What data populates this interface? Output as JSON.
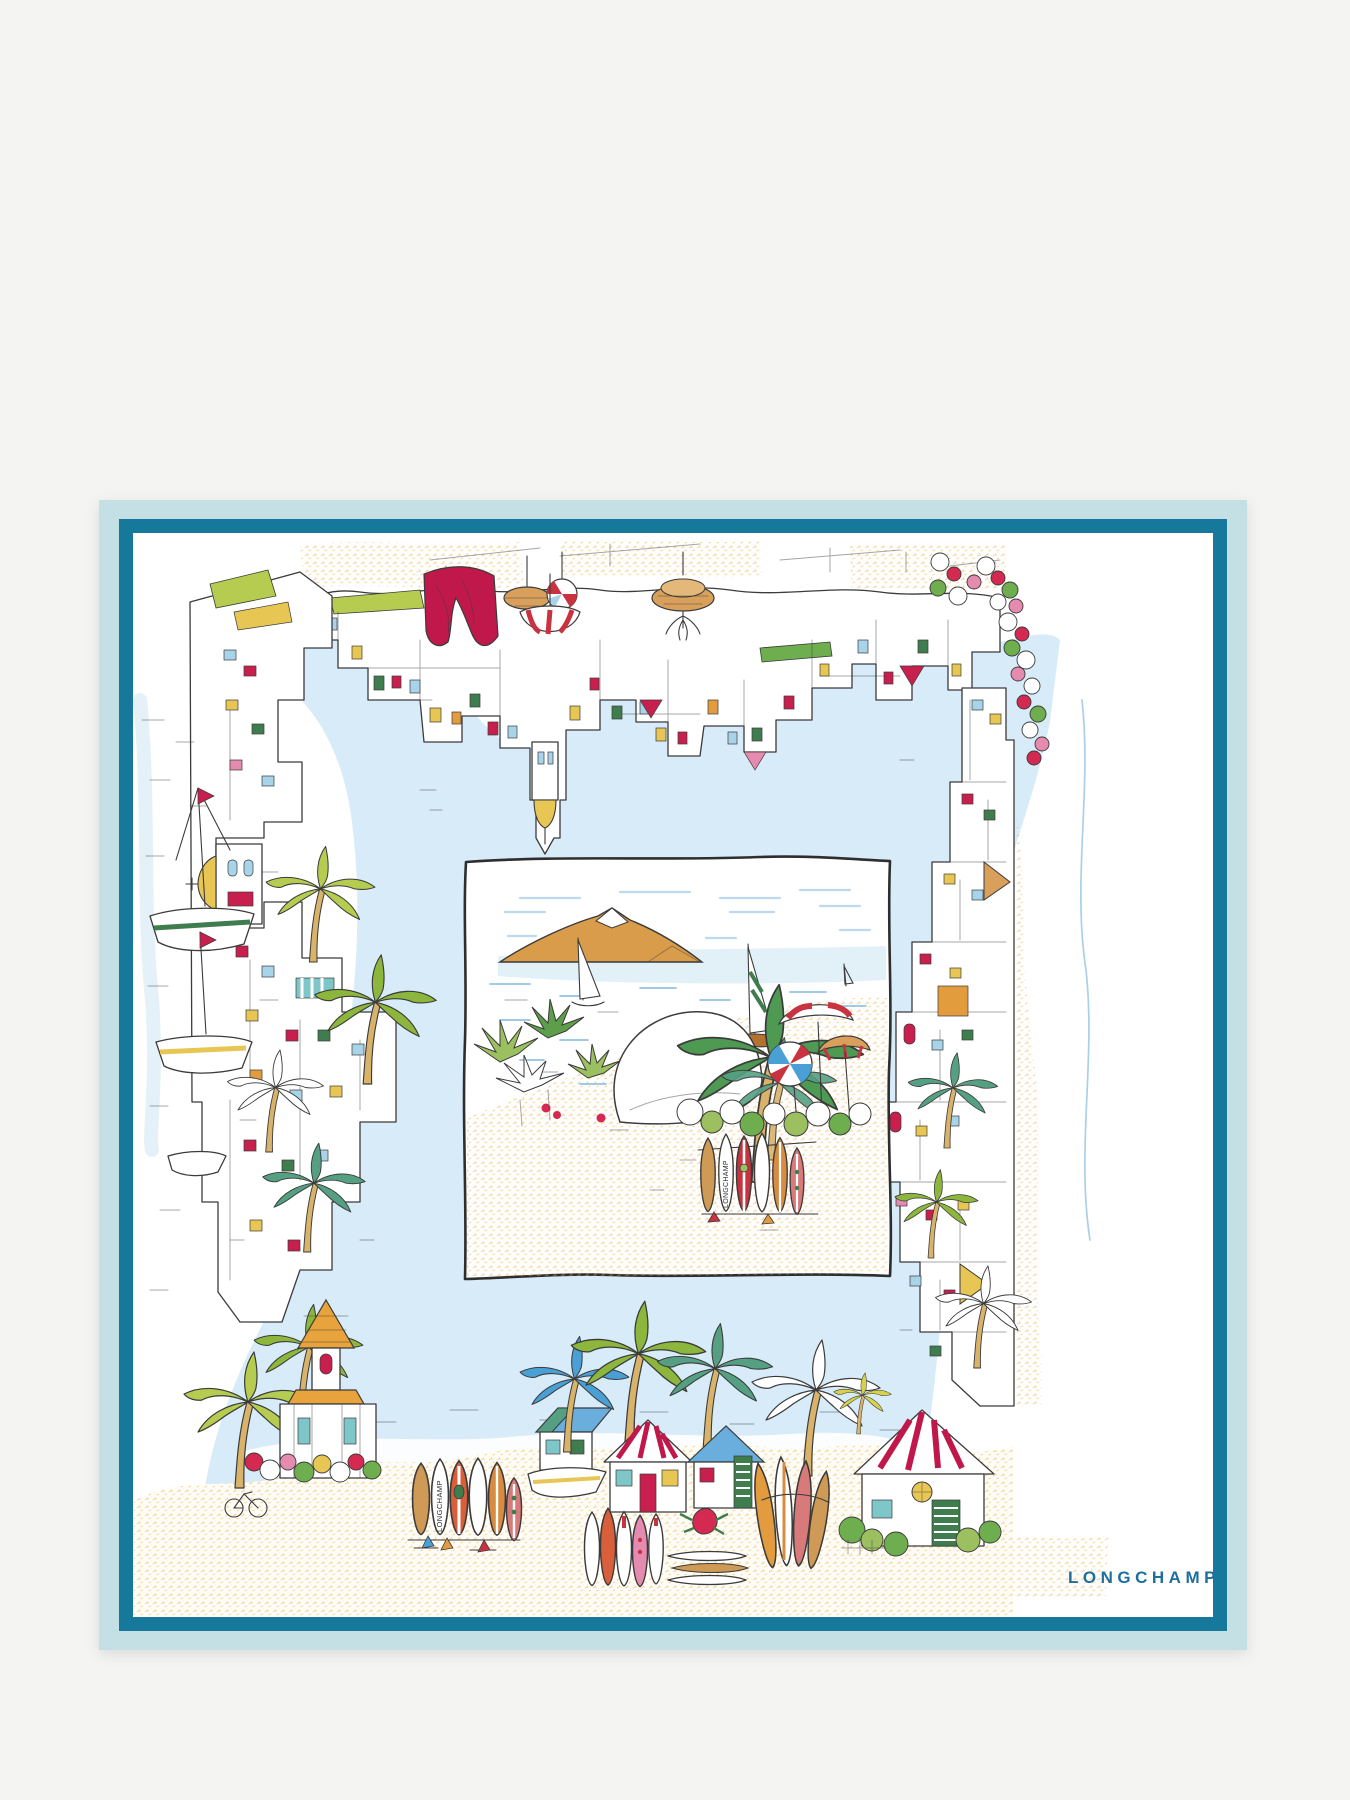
{
  "product": {
    "brand_wordmark": "LONGCHAMP",
    "surfboard_label_vignette": "LONGCHAMP",
    "surfboard_label_beach": "LONGCHAMP"
  },
  "colors": {
    "page_background": "#f4f4f2",
    "border_outer": "#c4e0e4",
    "border_inner": "#16799b",
    "scarf_ground": "#ffffff",
    "water": "#d7ebf8",
    "sand_scribble": "#f0a42e",
    "mountain": "#d89c4a",
    "accent_red": "#d42a52",
    "accent_crimson": "#c0184a",
    "palm_green": "#8cb63c",
    "palm_teal": "#55a083",
    "palm_blue": "#4a9fd4",
    "ink": "#3b3b3b",
    "wordmark": "#1e6f9e"
  }
}
